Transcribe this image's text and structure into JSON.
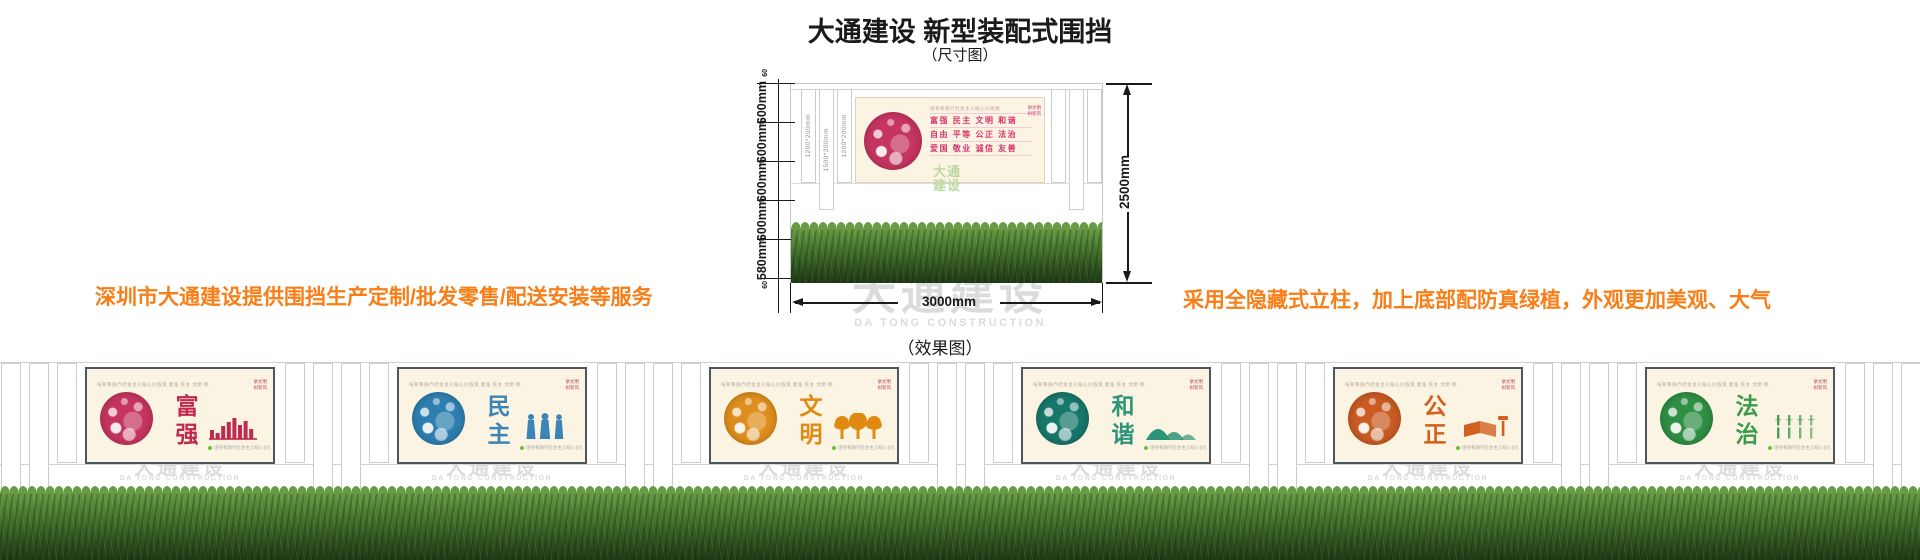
{
  "page": {
    "title": "大通建设 新型装配式围挡",
    "subtitle_dimension": "（尺寸图）",
    "subtitle_effect": "（效果图）",
    "left_note": "深圳市大通建设提供围挡生产定制/批发零售/配送安装等服务",
    "right_note": "采用全隐藏式立柱，加上底部配防真绿植，外观更加美观、大气"
  },
  "colors": {
    "accent_orange": "#F87E17",
    "ink": "#1A1A1A",
    "values_pink": "#D6336C",
    "logo_green": "#BCD9A4",
    "panel_bg": "#FBF4E3",
    "panel_border": "#4E585C",
    "watermark_gray": "#DBDBDB",
    "grass_light": "#679B44",
    "grass_dark": "#1F3A14"
  },
  "diagram": {
    "height_total_label": "2500mm",
    "width_total_label": "3000mm",
    "left_segment_labels": [
      "600mm",
      "600mm",
      "600mm",
      "600mm",
      "580mm"
    ],
    "top_small_label": "60",
    "bottom_small_label": "60",
    "post_size_labels": [
      "1200*200mm",
      "1500*200mm",
      "1200*200mm"
    ],
    "watermark_cn": "大通建设",
    "watermark_en": "DA TONG CONSTRUCTION",
    "panel": {
      "header": "培育和践行社会主义核心价值观",
      "values_rows": [
        [
          "富强",
          "民主",
          "文明",
          "和谐"
        ],
        [
          "自由",
          "平等",
          "公正",
          "法治"
        ],
        [
          "爱国",
          "敬业",
          "诚信",
          "友善"
        ]
      ],
      "badge": "讲文明\n树新风",
      "logo_watermark": "大通\n建设"
    }
  },
  "effect": {
    "header_strip": "培育和践行社会主义核心价值观  富强 民主 文明 和谐 自由 平等 公正 法治 爱国 敬业 诚信 友善",
    "badge": "讲文明\n树新风",
    "footnote": "培育和践行社会主义核心价值观",
    "watermark_cn": "大通建设",
    "watermark_en": "DA TONG CONSTRUCTION",
    "panels": [
      {
        "title": "富强",
        "color": "#C2294F",
        "circle_color": "#C53560",
        "motif": "skyline"
      },
      {
        "title": "民主",
        "color": "#3C84B5",
        "circle_color": "#2E7FB0",
        "motif": "people"
      },
      {
        "title": "文明",
        "color": "#E08A12",
        "circle_color": "#DE8E1C",
        "motif": "trees"
      },
      {
        "title": "和谐",
        "color": "#2E9478",
        "circle_color": "#17776B",
        "motif": "mountains"
      },
      {
        "title": "公正",
        "color": "#D2611F",
        "circle_color": "#C95B23",
        "motif": "book"
      },
      {
        "title": "法治",
        "color": "#3C9A4F",
        "circle_color": "#2F8F44",
        "motif": "bamboo"
      }
    ]
  }
}
